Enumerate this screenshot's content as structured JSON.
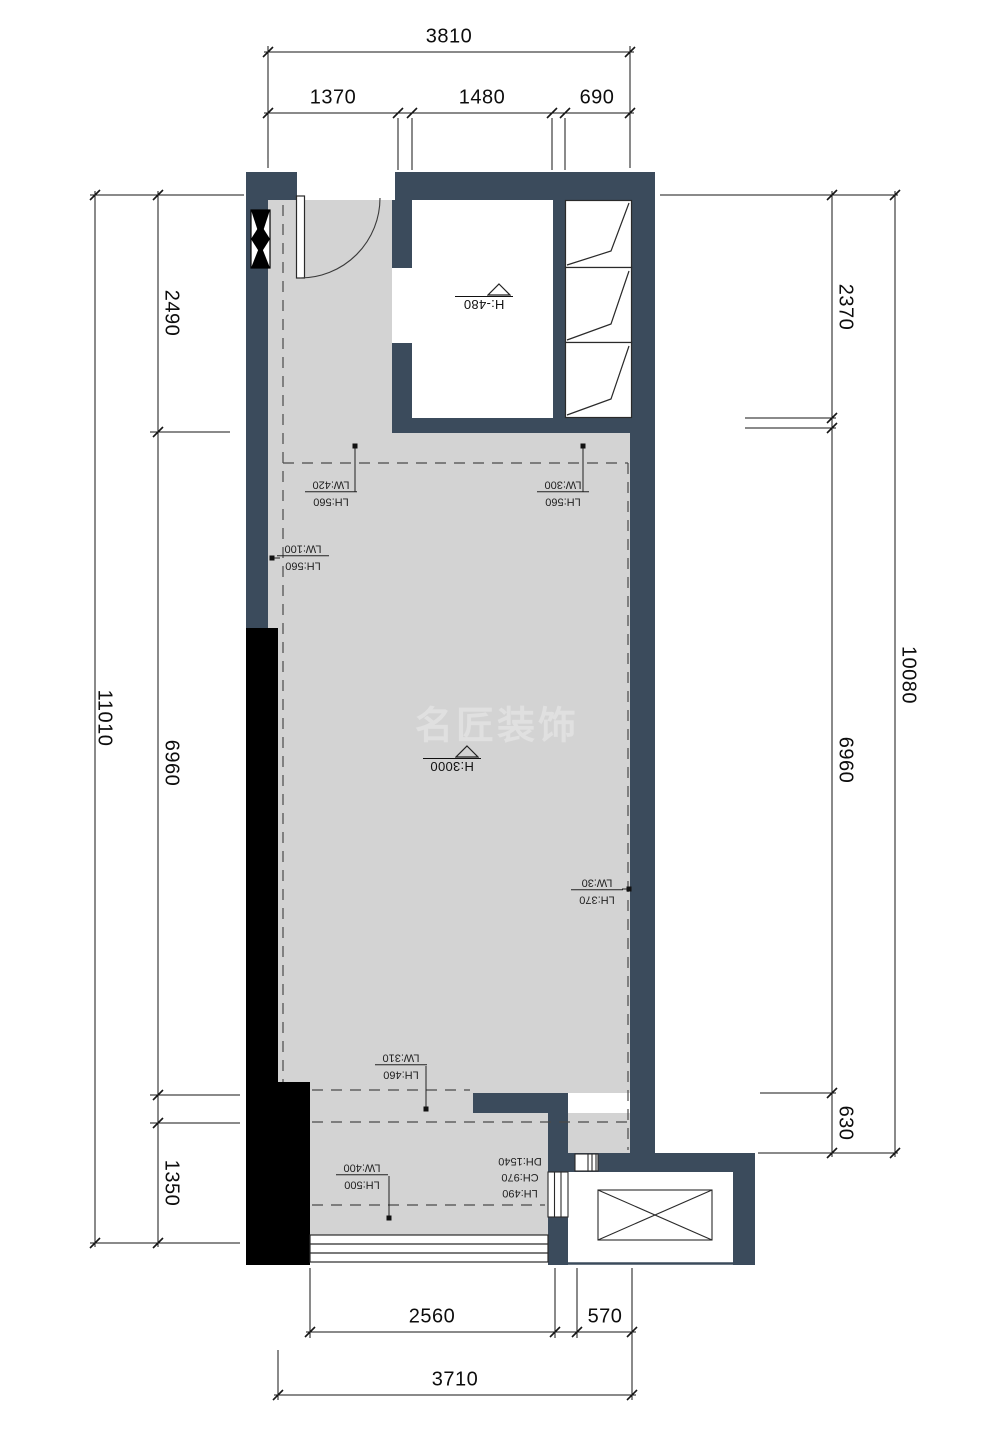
{
  "title": "apartment floor plan",
  "colors": {
    "wall": "#3b4b5c",
    "floor": "#d3d3d3",
    "black": "#000000",
    "line": "#161616",
    "dash": "#4a4a4a",
    "watermark": "#e0e0e0",
    "bg": "#ffffff"
  },
  "watermark": "名匠装饰",
  "dimensions": {
    "top": {
      "overall": "3810",
      "segments": [
        "1370",
        "1480",
        "690"
      ]
    },
    "left": {
      "overall": "11010",
      "segments": [
        "2490",
        "6960",
        "1350"
      ]
    },
    "right": {
      "overall": "10080",
      "segments": [
        "2370",
        "6960",
        "630"
      ]
    },
    "bottom": {
      "overall": "3710",
      "segments": [
        "2560",
        "570"
      ]
    }
  },
  "elevation_marks": [
    {
      "label": "H:-480"
    },
    {
      "label": "H:3000"
    }
  ],
  "beam_labels": [
    {
      "lh": "LH:560",
      "lw": "LW:420"
    },
    {
      "lh": "LH:560",
      "lw": "LW:300"
    },
    {
      "lh": "LH:560",
      "lw": "LW:100"
    },
    {
      "lh": "LH:370",
      "lw": "LW:30"
    },
    {
      "lh": "LH:460",
      "lw": "LW:310"
    },
    {
      "lh": "LH:500",
      "lw": "LW:400"
    }
  ],
  "opening_label": {
    "lines": [
      "LH:490",
      "CH:970",
      "DH:1540"
    ]
  }
}
